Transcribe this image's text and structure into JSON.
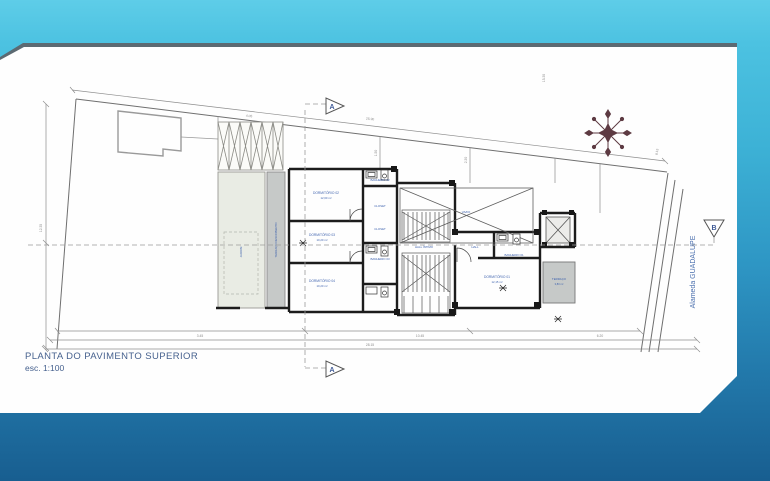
{
  "slide": {
    "title": "PLANTA DO PAVIMENTO SUPERIOR",
    "scale_label": "esc. 1:100",
    "street_name": "Alameda GUADALUPE",
    "section_markers": {
      "a": "A",
      "b": "B"
    },
    "colors": {
      "band_top": "#4cc2e1",
      "band_bottom": "#1b6496",
      "slide_bg": "#ffffff",
      "top_edge": "#5c6a72",
      "title_blue": "#46618e",
      "label_blue": "#3f63ae",
      "compass": "#5d3a42",
      "terrace_gray": "#c6c9c8",
      "garden_green": "#e9ece4"
    }
  },
  "plan": {
    "room_labels": [
      {
        "name": "DORMITÓRIO 02",
        "area": "12,60 m²"
      },
      {
        "name": "DORMITÓRIO 03",
        "area": "10,20 m²"
      },
      {
        "name": "DORMITÓRIO 04",
        "area": "10,20 m²"
      },
      {
        "name": "DORMITÓRIO 01",
        "area": "12,15 m²"
      },
      {
        "name": "CLOSET"
      },
      {
        "name": "CLOSET"
      },
      {
        "name": "BANHEIRO 02"
      },
      {
        "name": "BANHEIRO 03"
      },
      {
        "name": "BANHEIRO 01"
      },
      {
        "name": "HALL ÍNTIMO"
      },
      {
        "name": "TERRAÇO DESCOBERTO"
      },
      {
        "name": "TERRAÇO",
        "area": "3,80 m²"
      },
      {
        "name": "JARDIM"
      },
      {
        "name": "VAZIO"
      },
      {
        "name": "HALL"
      }
    ],
    "dimensions": [
      "25.90",
      "4.05",
      "1.50",
      "2.30",
      "15.30",
      "8.15",
      "3.45",
      "10.45",
      "6.20",
      "28.15",
      "12.35"
    ]
  }
}
